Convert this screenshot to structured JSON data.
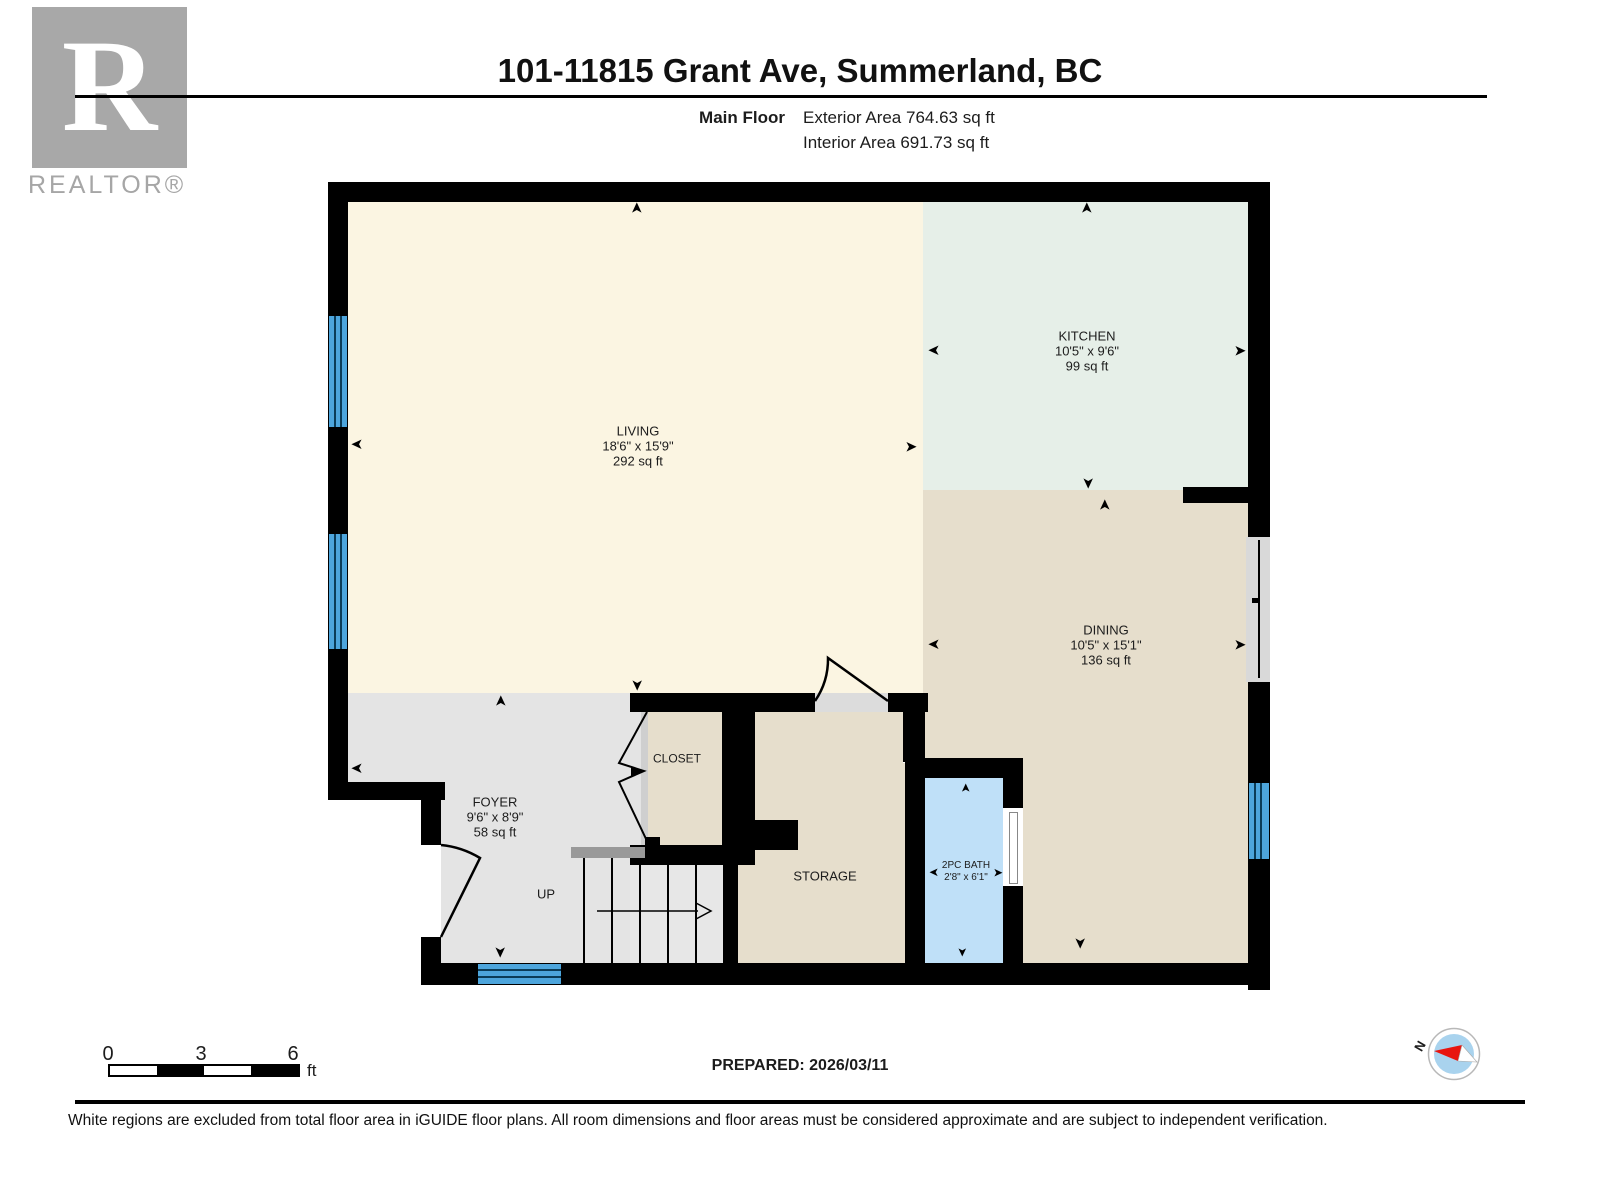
{
  "logo": {
    "r_letter": "R",
    "word": "REALTOR®"
  },
  "header": {
    "title": "101-11815 Grant Ave, Summerland, BC",
    "floor_label": "Main Floor",
    "exterior_area": "Exterior Area 764.63 sq ft",
    "interior_area": "Interior Area 691.73 sq ft"
  },
  "rooms": {
    "living": {
      "name": "LIVING",
      "dims": "18'6\" x 15'9\"",
      "area": "292 sq ft"
    },
    "kitchen": {
      "name": "KITCHEN",
      "dims": "10'5\" x 9'6\"",
      "area": "99 sq ft"
    },
    "dining": {
      "name": "DINING",
      "dims": "10'5\" x 15'1\"",
      "area": "136 sq ft"
    },
    "foyer": {
      "name": "FOYER",
      "dims": "9'6\" x 8'9\"",
      "area": "58 sq ft"
    },
    "closet": {
      "name": "CLOSET"
    },
    "storage": {
      "name": "STORAGE"
    },
    "bath": {
      "name": "2PC BATH",
      "dims": "2'8\" x 6'1\""
    },
    "stairs": {
      "label": "UP"
    }
  },
  "scale_bar": {
    "tick0": "0",
    "tick1": "3",
    "tick2": "6",
    "unit": "ft"
  },
  "footer": {
    "prepared": "PREPARED: 2026/03/11",
    "disclaimer": "White regions are excluded from total floor area in iGUIDE floor plans. All room dimensions and floor areas must be considered approximate and are subject to independent verification."
  },
  "compass": {
    "north_label": "N"
  },
  "icons": {
    "dim_arrow": "➤"
  },
  "colors": {
    "wall": "#000000",
    "living_fill": "#fbf5e2",
    "kitchen_fill": "#e6efe8",
    "dining_fill": "#e6decc",
    "foyer_fill": "#e4e4e4",
    "bath_fill": "#bfe0f8",
    "window_blue": "#4da5dc",
    "compass_blue": "#a9d3ee",
    "compass_red": "#e8150f",
    "logo_gray": "#a8a8a8"
  }
}
